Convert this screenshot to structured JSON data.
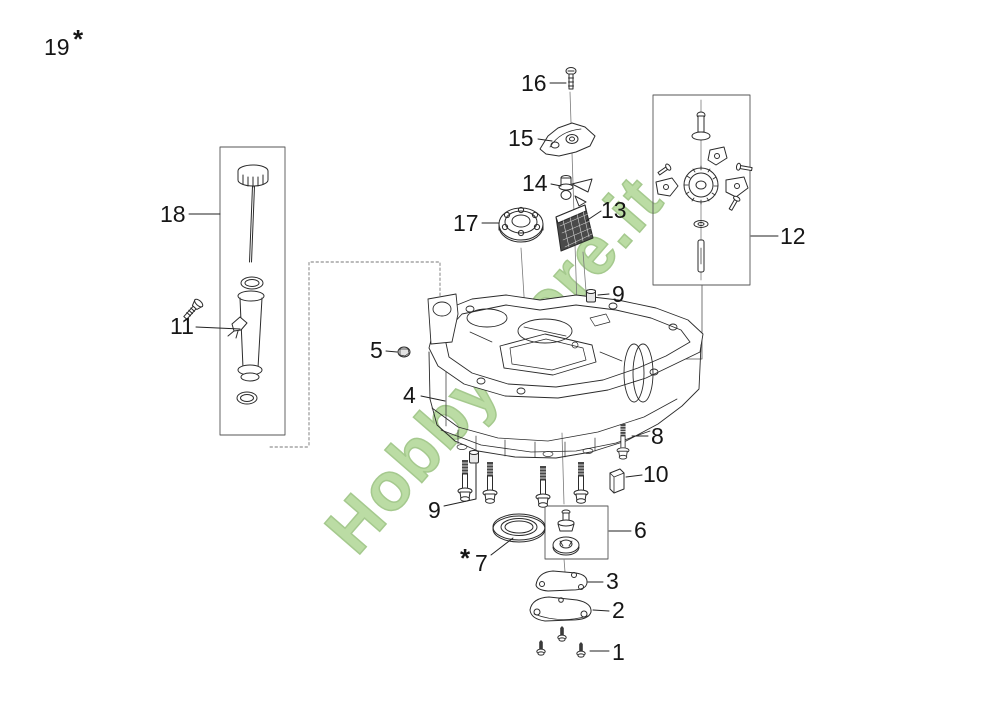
{
  "watermark": {
    "text": "HobbyStore.it",
    "color": "#abd48e"
  },
  "labels": {
    "n19": "19",
    "n19_star": "*",
    "n18": "18",
    "n11": "11",
    "n16": "16",
    "n15": "15",
    "n14": "14",
    "n17": "17",
    "n13": "13",
    "n12": "12",
    "n9_top": "9",
    "n5": "5",
    "n4": "4",
    "n8": "8",
    "n10": "10",
    "n9_bottom": "9",
    "n7_star": "*",
    "n7": "7",
    "n6": "6",
    "n3": "3",
    "n2": "2",
    "n1": "1"
  }
}
